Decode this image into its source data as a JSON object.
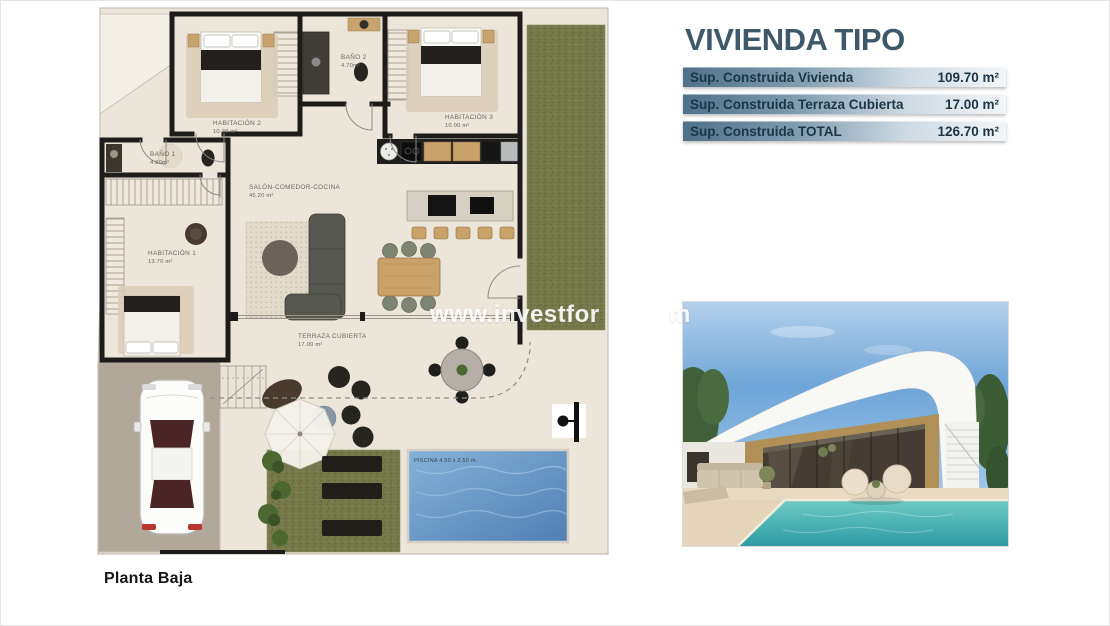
{
  "plan": {
    "caption": "Planta Baja",
    "rooms": [
      {
        "name": "HABITACIÓN 2",
        "area": "10.20 m²"
      },
      {
        "name": "BAÑO 2",
        "area": "4.70m²"
      },
      {
        "name": "HABITACIÓN 3",
        "area": "10.00 m²"
      },
      {
        "name": "BAÑO 1",
        "area": "4.80m²"
      },
      {
        "name": "HABITACIÓN 1",
        "area": "13.70 m²"
      },
      {
        "name": "SALÓN-COMEDOR-COCINA",
        "area": "45.20 m²"
      },
      {
        "name": "TERRAZA CUBIERTA",
        "area": "17.00 m²"
      }
    ],
    "pool_label": "PISCINA 4.50 x 2.50 m."
  },
  "info": {
    "title": "VIVIENDA TIPO",
    "rows": [
      {
        "label": "Sup. Construida Vivienda",
        "value": "109.70 m²"
      },
      {
        "label": "Sup. Construida Terraza Cubierta",
        "value": "17.00 m²"
      },
      {
        "label": "Sup. Construida TOTAL",
        "value": "126.70 m²"
      }
    ]
  },
  "watermark": {
    "prefix": "www.investfor",
    "suffix": "m"
  },
  "colors": {
    "panel_title": "#3e5a6a",
    "row_gradient_start": "#4e7089",
    "row_text": "#1a3647",
    "plan_floor": "#ece6da",
    "plan_wall": "#1d1c1a",
    "plan_grass": "#75794b",
    "plan_pool": "#5d94c6",
    "photo_sky": "#6ea5d8",
    "photo_wall": "#b19057",
    "photo_pool": "#2d9da3"
  }
}
